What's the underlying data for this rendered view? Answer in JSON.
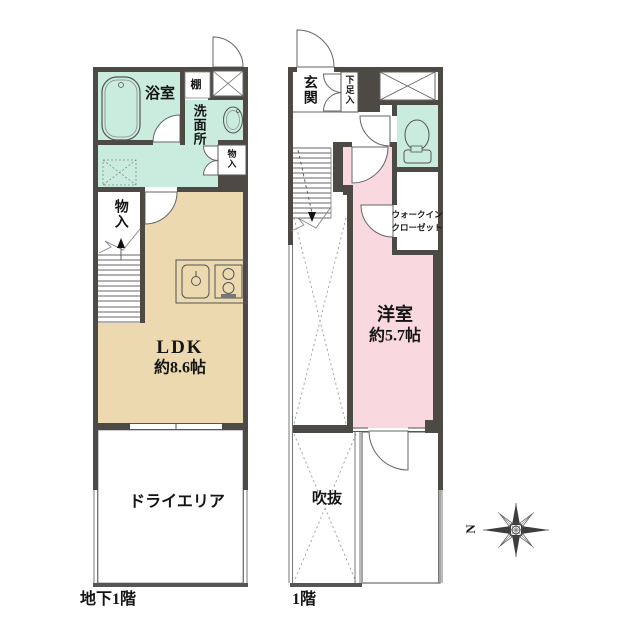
{
  "document": {
    "type": "floor-plan",
    "floors": 2
  },
  "colors": {
    "wall": "#4d4a45",
    "wet_area": "#c9ecdf",
    "ldk": "#ecd9b0",
    "bedroom": "#f9d8e0",
    "line": "#555555"
  },
  "b1f": {
    "floor_label": "地下1階",
    "bath": "浴室",
    "shelf": "棚",
    "washroom": "洗面所",
    "storage_small": "物入",
    "storage": "物入",
    "ldk_name": "LDK",
    "ldk_size": "約8.6帖",
    "dry_area": "ドライエリア"
  },
  "f1": {
    "floor_label": "1階",
    "entrance": "玄関",
    "shoe_storage": "下足入",
    "wic_line1": "ウォークイン",
    "wic_line2": "クローゼット",
    "bedroom_name": "洋室",
    "bedroom_size": "約5.7帖",
    "void_space": "吹抜"
  },
  "compass": {
    "north_label": "N",
    "orientation": "north-left"
  }
}
